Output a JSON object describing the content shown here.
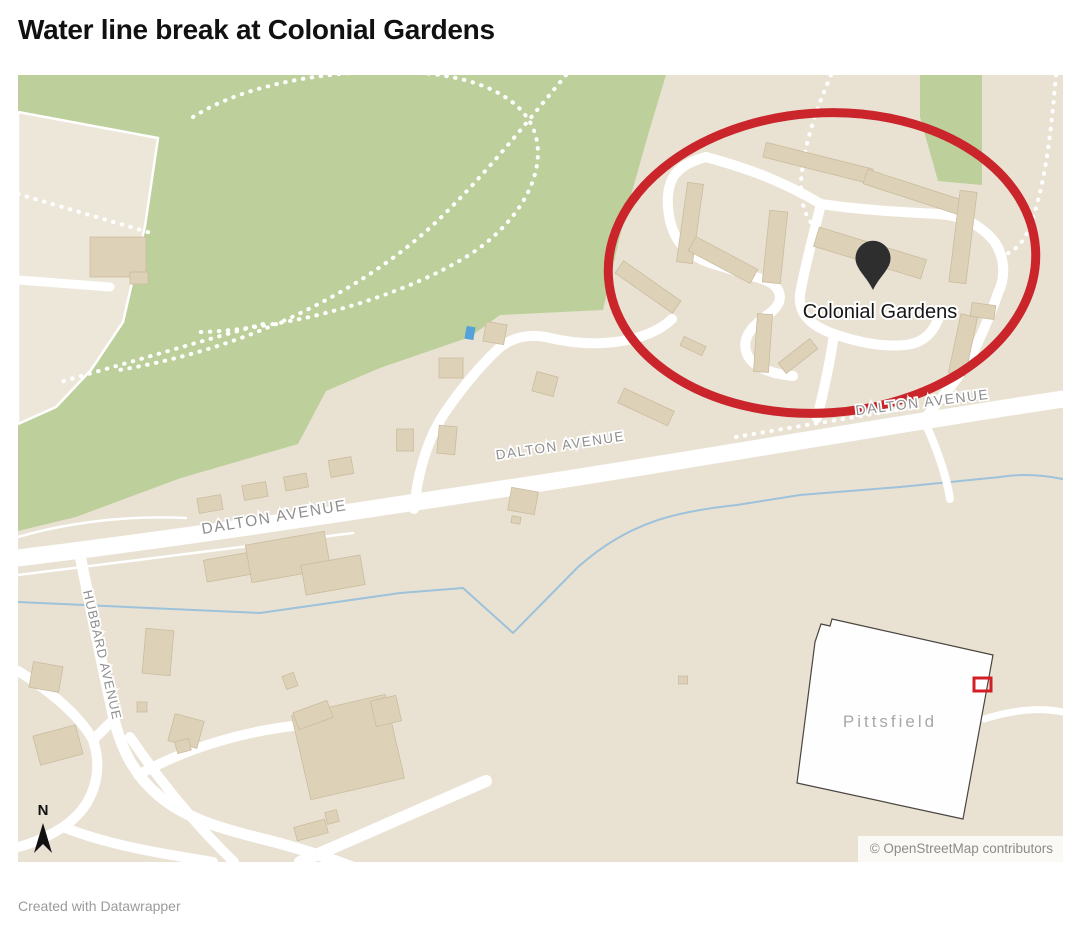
{
  "title": "Water line break at Colonial Gardens",
  "footer_credit": "Created with Datawrapper",
  "map": {
    "attribution": "© OpenStreetMap contributors",
    "marker_label": "Colonial Gardens",
    "inset_label": "Pittsfield",
    "streets": {
      "dalton": "DALTON AVENUE",
      "hubbard": "HUBBARD AVENUE"
    },
    "compass_label": "N",
    "colors": {
      "highlight_red": "#c9252b",
      "park_green": "#bdd09c",
      "land_beige": "#e9e2d3",
      "building_tan": "#ddd1b8",
      "road_white": "#ffffff",
      "water_blue": "#9dc2da",
      "pin_dark": "#2e2e2e",
      "inset_marker_red": "#d41e26"
    }
  }
}
